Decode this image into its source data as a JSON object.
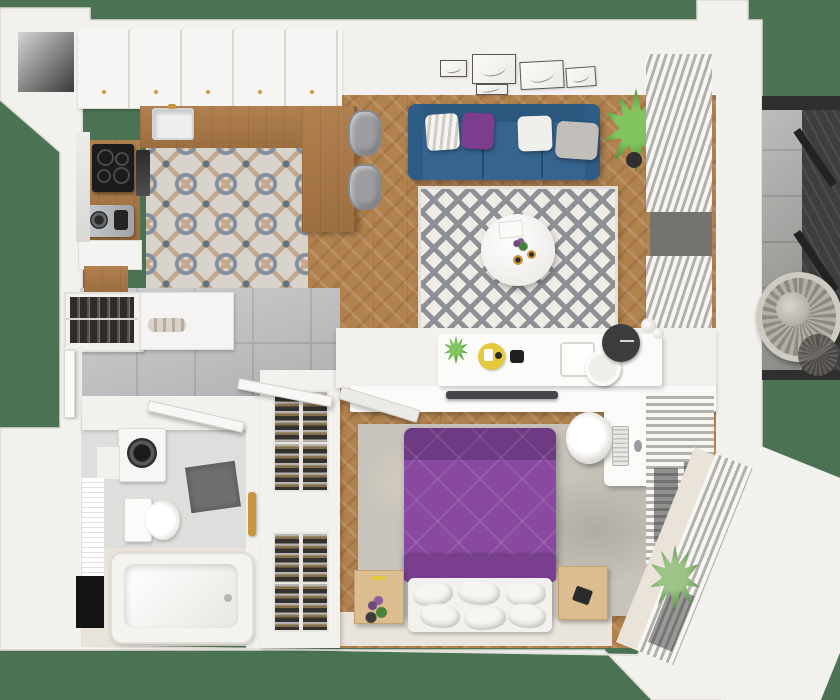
{
  "scene": {
    "type": "3d-apartment-floor-plan-top-view",
    "background_color": "#4a7253",
    "palette": {
      "wall": "#f2f1ee",
      "wood_floor": "#b2824e",
      "kitchen_tile_motif": "#7e8da0",
      "hall_tile": "#b9babc",
      "sofa_blue": "#35648e",
      "bed_purple": "#8a49a0",
      "accent_gold": "#c9973f",
      "yellow_tray": "#e5c93c",
      "plant_green": "#3f8f33",
      "balcony_gray_wall": "#3e3e3e"
    },
    "rooms": [
      {
        "name": "kitchen",
        "floor": "patterned-ceramic-tile",
        "items": [
          "upper-cabinets-row",
          "wood-countertop-L",
          "sink",
          "induction-cooktop",
          "oven-panel",
          "coffee-machine",
          "open-shelf"
        ]
      },
      {
        "name": "dining-nook",
        "items": [
          "wood-peninsula-table",
          "gray-chair",
          "gray-chair"
        ]
      },
      {
        "name": "living-room",
        "floor": "herringbone-wood",
        "items": [
          "blue-three-seat-sofa",
          "striped-pillow",
          "purple-pillow",
          "white-pillow",
          "gray-pillow",
          "gallery-wall-5-frames",
          "diamond-pattern-rug",
          "round-coffee-table",
          "candles",
          "potted-plant",
          "vertical-window-blinds"
        ]
      },
      {
        "name": "bedroom",
        "floor": "herringbone-wood",
        "items": [
          "double-bed-purple-duvet",
          "white-pillows",
          "area-rug",
          "nightstand-left",
          "nightstand-right",
          "plant-on-nightstand",
          "console-shelf",
          "yellow-round-tray",
          "decor-tray",
          "round-mirror",
          "wall-clock",
          "sphere-lamp",
          "wall-tv",
          "tv-bracket",
          "desk",
          "office-chair",
          "keyboard",
          "monitor",
          "window-blinds",
          "corner-window-blinds",
          "potted-plant"
        ]
      },
      {
        "name": "hallway",
        "floor": "gray-tile",
        "items": [
          "open-wardrobe-with-hangers",
          "storage-cabinet",
          "towel-rolls",
          "shoe-rack-column-4-modules",
          "entry-door",
          "bathroom-door",
          "closet-door"
        ]
      },
      {
        "name": "bathroom",
        "floor": "gray-and-herringbone-tile",
        "items": [
          "washing-machine",
          "side-cabinet",
          "toilet",
          "subway-tile-wall",
          "shower-area",
          "dark-bath-mat",
          "gold-shower-column",
          "bathtub",
          "gold-faucet",
          "black-panel"
        ]
      },
      {
        "name": "balcony",
        "style": "grayscale",
        "items": [
          "hanging-wicker-chair",
          "slatted-dark-wall",
          "tile-floor"
        ]
      }
    ],
    "counts": {
      "wall_art_frames": 5,
      "shoe_rack_modules": 4,
      "sofa_pillows": 4,
      "dining_chairs": 2
    }
  }
}
